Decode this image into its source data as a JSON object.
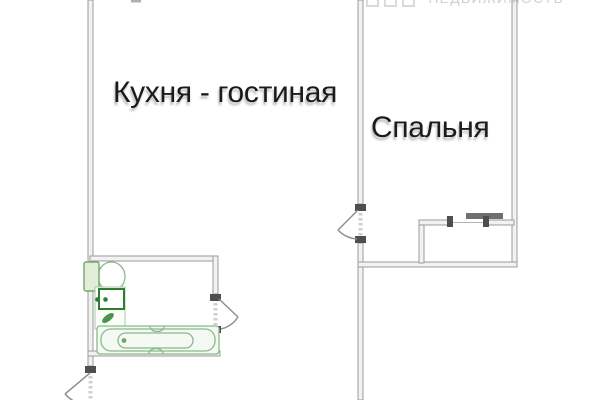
{
  "watermark": {
    "brand": "НЕДВИЖИМОСТЬ",
    "square_icons": 3
  },
  "floorplan": {
    "rooms": [
      {
        "id": "kitchen-living",
        "label": "Кухня - гостиная"
      },
      {
        "id": "bedroom",
        "label": "Спальня"
      }
    ],
    "fixtures": [
      "toilet-icon",
      "sink-icon",
      "leaf-icon",
      "bathtub-icon",
      "sliding-wardrobe-icon",
      "door-swing-icon"
    ]
  },
  "colors": {
    "wall": "#9b9b9b",
    "jamb": "#4e4e4e",
    "fixture": "#2e7d32",
    "fixtureLight": "#8ab98a",
    "watermark": "#d0d0d0"
  }
}
